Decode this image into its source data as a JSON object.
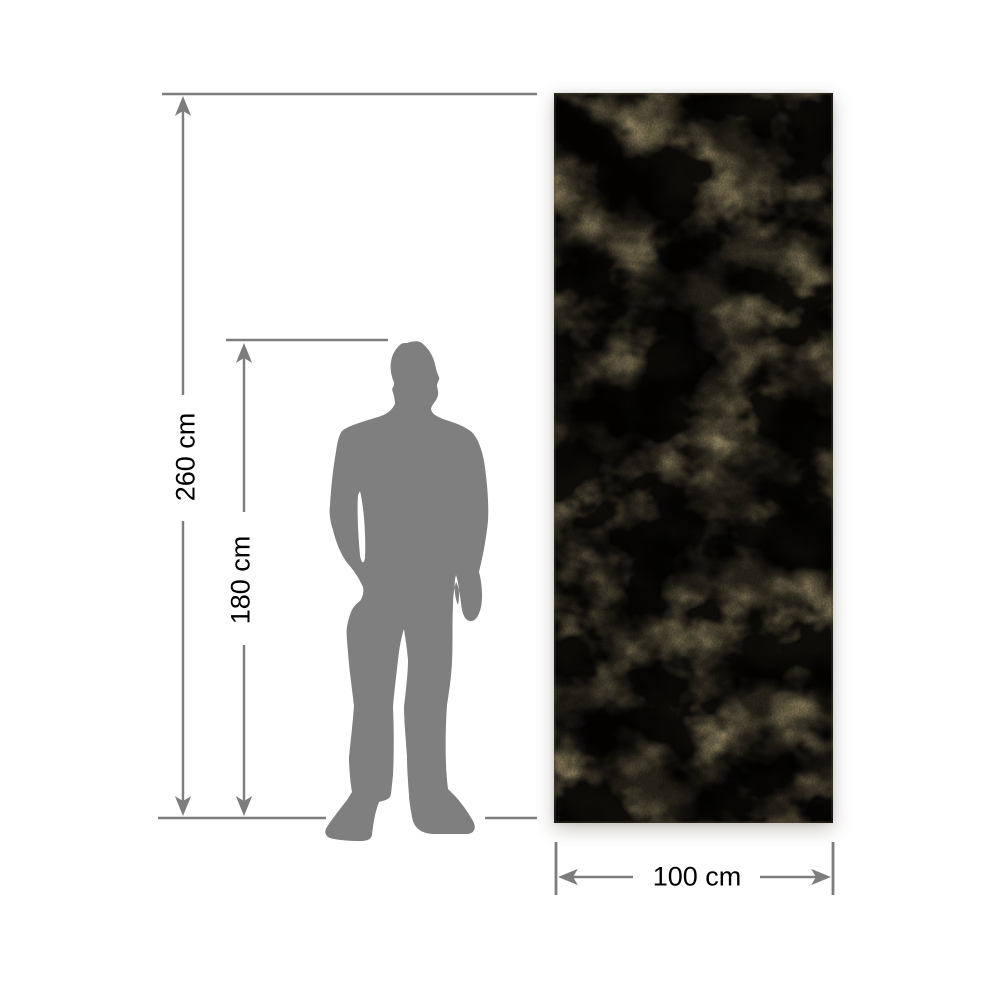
{
  "figure": {
    "type": "product-dimension-diagram",
    "dimensions": {
      "height_label": "260 cm",
      "person_height_label": "180 cm",
      "width_label": "100 cm"
    },
    "colors": {
      "line": "#7d7d7d",
      "silhouette": "#7f7f7f",
      "label_text": "#000000",
      "panel_base": "#b1a077",
      "panel_dark": "#877e60",
      "panel_light": "#cbb786",
      "background": "#ffffff"
    }
  }
}
